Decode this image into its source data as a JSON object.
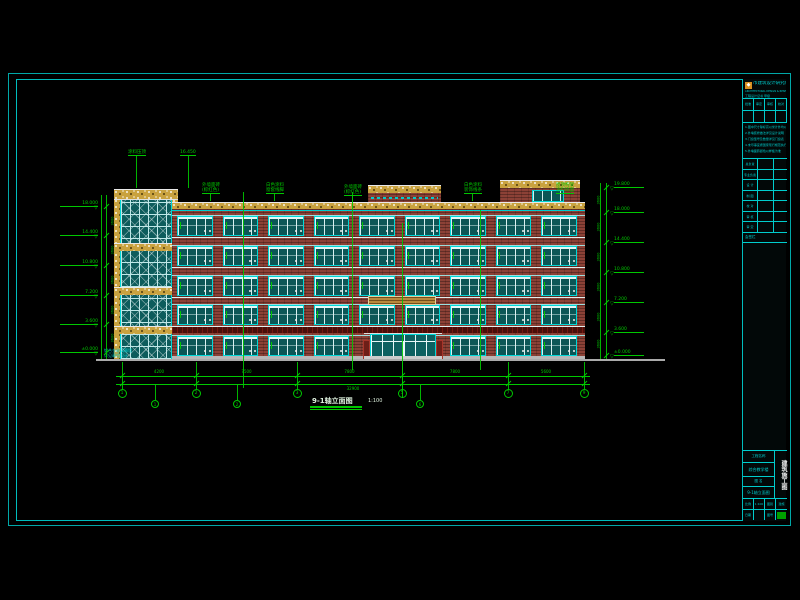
{
  "sheet": {
    "bg": "#000000",
    "frame_color": "#00a8a8",
    "inner_frame_color": "#00bdbd"
  },
  "drawing_title": {
    "text": "9-1轴立面图",
    "scale": "1:100"
  },
  "colors": {
    "green": "#00c800",
    "cyan": "#00cdcd",
    "white": "#e8e8e8",
    "brick": "#8c4136",
    "accent_band": "#490f0a",
    "speckle": "#c9a23f",
    "glass": "#0b5656",
    "glass_frame": "#00d8d8",
    "mullion": "#d8f0f0",
    "ground": "#aaaaaa",
    "louver": "#b9893c",
    "stamp": "#00a000"
  },
  "elevation": {
    "ground": {
      "x1": 96,
      "x2": 665,
      "y": 359
    },
    "facade": {
      "x": 172,
      "w": 413,
      "top": 202,
      "parapet_h": 7,
      "bottom": 360
    },
    "floors": [
      [
        216,
        236
      ],
      [
        246,
        266
      ],
      [
        276,
        296
      ],
      [
        305,
        325
      ],
      [
        336,
        356
      ]
    ],
    "bays": {
      "count": 9,
      "x0": 177,
      "x1": 577,
      "pier": 10
    },
    "tower": {
      "x": 120,
      "w": 52,
      "top": 189,
      "cap_x": 114,
      "cap_w": 64,
      "cap_h": 11,
      "bands_y": [
        243,
        287,
        326
      ],
      "band_h": 8
    },
    "center_block": {
      "x": 368,
      "w": 73,
      "top": 185
    },
    "bulkhead": {
      "x": 500,
      "w": 80,
      "top": 180,
      "win_x": 532,
      "win_w": 32,
      "win_y": 190,
      "win_h": 12
    },
    "louver_band": {
      "x": 368,
      "w": 68,
      "y": 296,
      "h": 9
    },
    "dark_band": {
      "y": 327,
      "h": 6
    },
    "plinth": {
      "y": 356,
      "h": 4
    },
    "entrance": {
      "x": 370,
      "w": 66,
      "y": 334,
      "h": 24
    },
    "tower_note": [
      "铝合金玻璃幕墙",
      "详见幕墙设计"
    ],
    "callouts": [
      {
        "x": 128,
        "y": 150,
        "lines": [
          "涂料压顶"
        ],
        "to": 188
      },
      {
        "x": 180,
        "y": 150,
        "lines": [
          "16.450"
        ],
        "to": 188
      },
      {
        "x": 202,
        "y": 183,
        "lines": [
          "外墙面砖",
          "(棕红色)"
        ],
        "to": 201
      },
      {
        "x": 266,
        "y": 183,
        "lines": [
          "白色涂料",
          "窗套线脚"
        ],
        "to": 201
      },
      {
        "x": 344,
        "y": 185,
        "lines": [
          "外墙面砖",
          "(棕红色)"
        ],
        "to": 201
      },
      {
        "x": 464,
        "y": 183,
        "lines": [
          "白色涂料",
          "装饰线条"
        ],
        "to": 201
      },
      {
        "x": 556,
        "y": 183,
        "lines": [
          "屋顶构架",
          "涂料饰面"
        ],
        "to": 179
      }
    ],
    "grid_lines": [
      {
        "x": 243,
        "y1": 192,
        "y2": 388
      },
      {
        "x": 352,
        "y1": 192,
        "y2": 370
      },
      {
        "x": 402,
        "y1": 223,
        "y2": 398
      },
      {
        "x": 480,
        "y1": 210,
        "y2": 370
      }
    ],
    "levels_left": [
      {
        "y": 207,
        "v": "18.000"
      },
      {
        "y": 236,
        "v": "14.400"
      },
      {
        "y": 266,
        "v": "10.800"
      },
      {
        "y": 296,
        "v": "7.200"
      },
      {
        "y": 325,
        "v": "3.600"
      },
      {
        "y": 353,
        "v": "±0.000"
      }
    ],
    "levels_right": [
      {
        "y": 188,
        "v": "19.800"
      },
      {
        "y": 213,
        "v": "18.000"
      },
      {
        "y": 243,
        "v": "14.400"
      },
      {
        "y": 273,
        "v": "10.800"
      },
      {
        "y": 303,
        "v": "7.200"
      },
      {
        "y": 333,
        "v": "3.600"
      },
      {
        "y": 356,
        "v": "±0.000"
      }
    ],
    "grid_bubbles": [
      {
        "x": 122,
        "n": "1"
      },
      {
        "x": 196,
        "n": "2"
      },
      {
        "x": 297,
        "n": "3"
      },
      {
        "x": 402,
        "n": "5"
      },
      {
        "x": 508,
        "n": "7"
      },
      {
        "x": 584,
        "n": "9"
      }
    ],
    "sub_bubbles": [
      {
        "x": 155,
        "n": "1"
      },
      {
        "x": 237,
        "n": "2"
      },
      {
        "x": 420,
        "n": "6"
      }
    ],
    "dims": {
      "segments": [
        "4200",
        "7500",
        "7800",
        "7800",
        "5600"
      ],
      "overall": "32900",
      "story_seg": "3600"
    }
  },
  "title_block": {
    "logo_glyph": "◆",
    "company": "市建筑设计研究院",
    "company_en": "ARCHITECTURAL DESIGN & RESEARCH INSTITUTE",
    "cert": "工程设计证书 甲级",
    "approval_table": [
      [
        "批准",
        "审定",
        "审核",
        "校对"
      ],
      [
        "",
        "",
        "",
        ""
      ]
    ],
    "notes": [
      "1.图中尺寸除标高以米计外均以毫米计",
      "2.外墙装修做法详见设计说明",
      "3.门窗型号及数量详见门窗表",
      "4.未尽事宜按国家现行规范执行",
      "5.外墙面砖颜色以样板为准"
    ],
    "sig_rows": [
      [
        "总负责",
        ""
      ],
      [
        "专业负责",
        ""
      ],
      [
        "设 计",
        ""
      ],
      [
        "制 图",
        ""
      ],
      [
        "校 对",
        ""
      ],
      [
        "审 核",
        ""
      ],
      [
        "审 定",
        ""
      ]
    ],
    "huiqian_label": "会签栏",
    "project_label": "工程名称",
    "project_value": "综合教学楼",
    "drawing_label": "图  名",
    "drawing_value": "9-1轴立面图",
    "vertical_text": "建筑施工图",
    "bottom_rows": [
      [
        "比例",
        "1:100",
        "图别",
        "建施"
      ],
      [
        "日期",
        "",
        "图号",
        ""
      ]
    ]
  }
}
